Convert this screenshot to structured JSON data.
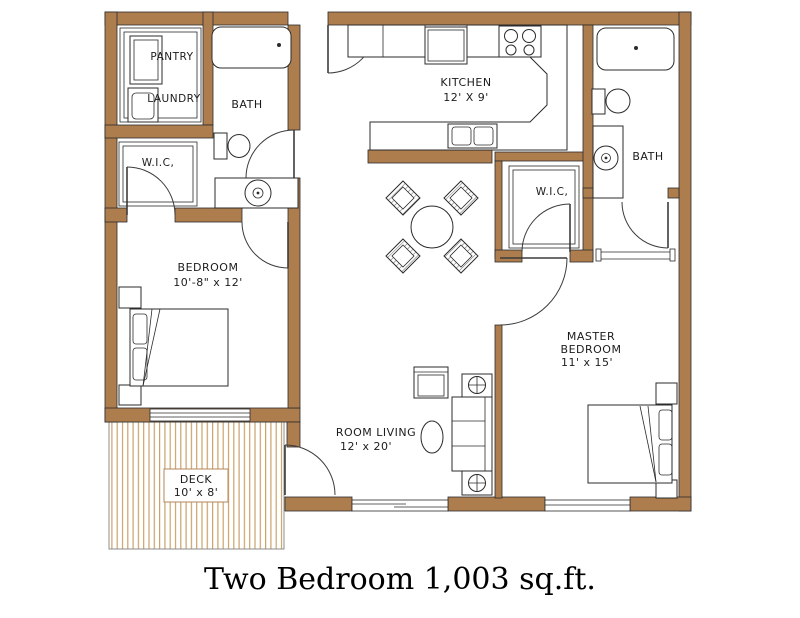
{
  "title": "Two Bedroom 1,003 sq.ft.",
  "plan": {
    "rooms": {
      "pantry": {
        "label": "PANTRY"
      },
      "laundry": {
        "label": "LAUNDRY"
      },
      "bath_left": {
        "label": "BATH"
      },
      "wic_left": {
        "label": "W.I.C,"
      },
      "kitchen": {
        "label": "KITCHEN",
        "dims": "12' X 9'"
      },
      "bedroom": {
        "label": "BEDROOM",
        "dims": "10'-8\" x 12'"
      },
      "wic_right": {
        "label": "W.I.C,"
      },
      "bath_right": {
        "label": "BATH"
      },
      "master_bedroom": {
        "label_line1": "MASTER",
        "label_line2": "BEDROOM",
        "dims": "11' x 15'"
      },
      "living_room": {
        "label": "ROOM LIVING",
        "dims": "12' x 20'"
      },
      "deck": {
        "label": "DECK",
        "dims": "10' x 8'"
      }
    },
    "fixtures": [
      "bathtub",
      "toilet",
      "sink-vanity",
      "washer",
      "pantry-shelves",
      "refrigerator",
      "stove",
      "kitchen-sink",
      "breakfast-bar",
      "dining-table",
      "dining-chair",
      "sofa",
      "armchair",
      "coffee-table",
      "end-table-lamp",
      "bed",
      "nightstand",
      "door-swing",
      "window",
      "sliding-door"
    ]
  },
  "colors": {
    "wall": "#ae7d4e",
    "deck_board": "#c9a26a",
    "line": "#2b2b2b",
    "text": "#1c1c1c",
    "background": "#ffffff"
  }
}
